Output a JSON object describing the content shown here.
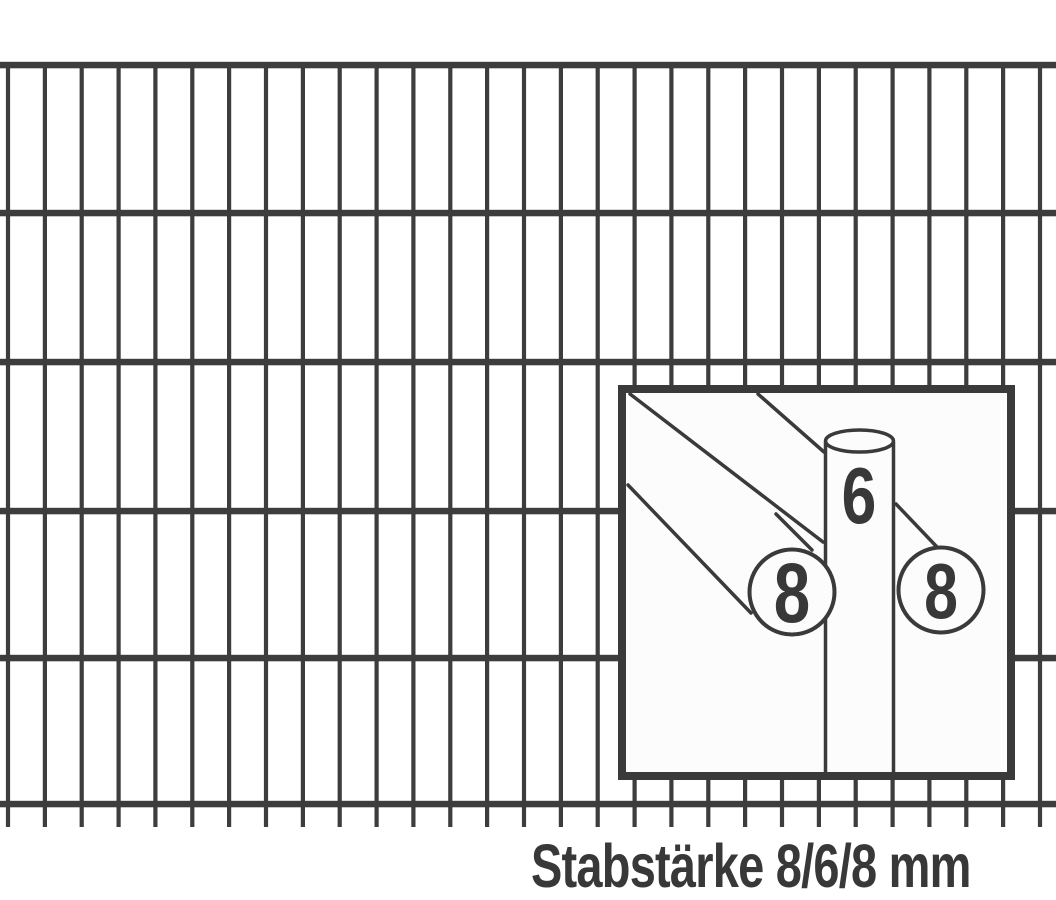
{
  "figure": {
    "type": "technical-illustration",
    "subject": "double-rod fence mesh panel (Doppelstabmatte) with bar-thickness detail inset"
  },
  "caption": {
    "text": "Stabstärke 8/6/8 mm"
  },
  "inset": {
    "front_rod_label": "8",
    "vertical_rod_label": "6",
    "rear_rod_label": "8"
  },
  "colors": {
    "background": "#ffffff",
    "bar": "#3d3d3d",
    "line": "#3a3a3a",
    "text": "#383838",
    "inset_background": "#fcfcfc",
    "inset_border": "#3a3a3a"
  },
  "fence": {
    "horizontal": {
      "y_positions": [
        65,
        213,
        362,
        511,
        658,
        804
      ],
      "thickness": 6.5
    },
    "vertical": {
      "count": 29,
      "start_x": 8,
      "spacing": 36.857,
      "thickness": 4.2,
      "top": 62,
      "bottom": 827
    }
  }
}
